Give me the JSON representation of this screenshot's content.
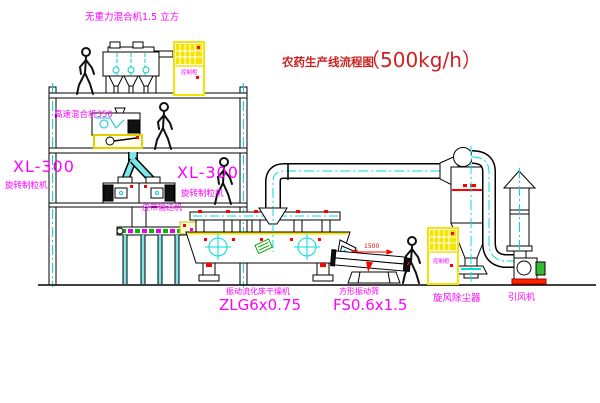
{
  "title": {
    "text": "农药生产线流程图",
    "capacity": "（500kg/h）"
  },
  "equipment_labels": {
    "gravity_mixer": "无重力混合机1.5 立方",
    "high_speed_mixer": "高速混合机350",
    "granulator_left": {
      "model": "XL-300",
      "name": "旋转制粒机"
    },
    "granulator_right": {
      "model": "XL-300",
      "name": "旋转制粒机"
    },
    "belt_conveyor": "皮带输送机",
    "fluid_bed_dryer": {
      "name": "振动流化床干燥机",
      "model": "ZLG6x0.75"
    },
    "square_sieve": {
      "name": "方形振动筛",
      "model": "FS0.6x1.5"
    },
    "cyclone": "旋风除尘器",
    "induced_draft_fan": "引风机",
    "control_cabinet_upper": "控制柜",
    "control_cabinet_lower": "控制柜"
  },
  "dimensions": {
    "sieve_length": "1500"
  },
  "colors": {
    "label_magenta": "#ff00ff",
    "title_red": "#cc2222",
    "line_black": "#000000",
    "centerline_cyan": "#00dddd",
    "cabinet_yellow": "#f5e400",
    "accent_red": "#ff0000",
    "accent_green": "#00aa00",
    "background": "#ffffff"
  }
}
